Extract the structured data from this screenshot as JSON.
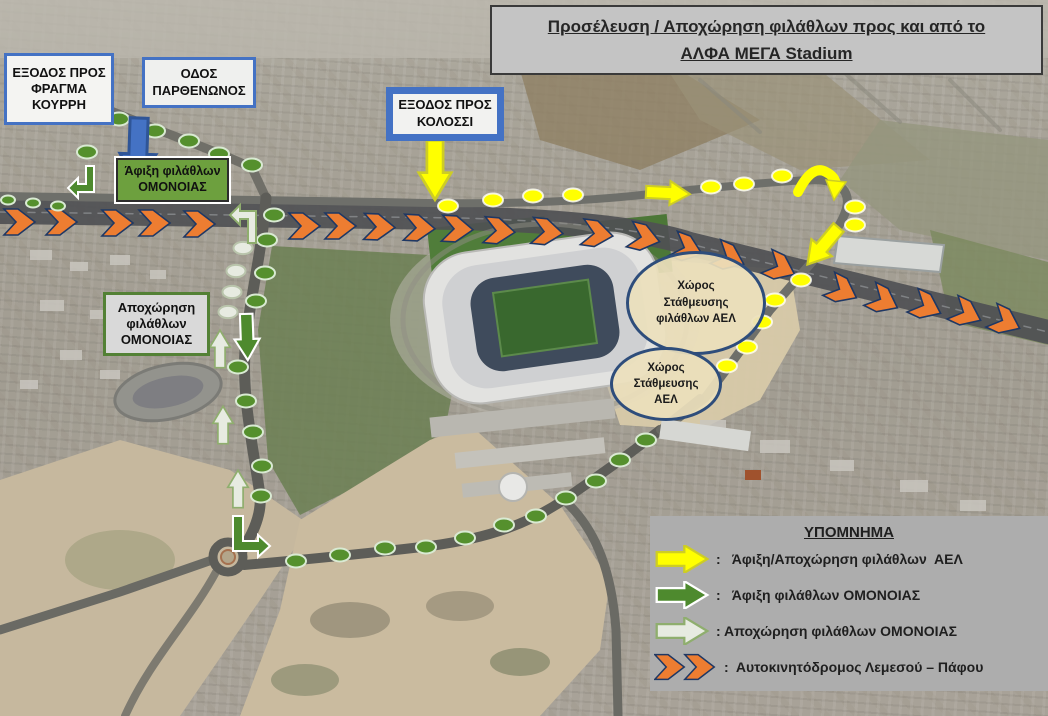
{
  "title": {
    "line1": " Προσέλευση / Αποχώρηση  φιλάθλων προς και από το",
    "line2": "ΑΛΦΑ ΜΕΓΑ Stadium"
  },
  "boxes": {
    "exit_kourri": "ΕΞΟΔΟΣ ΠΡΟΣ\nΦΡΑΓΜΑ\nΚΟΥΡΡΗ",
    "odos_parthenonos": "ΟΔΟΣ\nΠΑΡΘΕΝΩΝΟΣ",
    "exit_kolossi": "ΕΞΟΔΟΣ ΠΡΟΣ\nΚΟΛΟΣΣΙ",
    "arrival_omonoias": "Άφιξη φιλάθλων\nΟΜΟΝΟΙΑΣ",
    "departure_omonoias": "Αποχώρηση\nφιλάθλων\nΟΜΟΝΟΙΑΣ",
    "parking_ael_fans": "Χώρος\nΣτάθμευσης\nφιλάθλων  ΑΕΛ",
    "parking_ael": "Χώρος\nΣτάθμευσης\nΑΕΛ"
  },
  "legend": {
    "title": "ΥΠΟΜΝΗΜΑ",
    "items": [
      {
        "icon": "yellow-arrow-icon",
        "label": ":   Άφιξη/Αποχώρηση φιλάθλων  ΑΕΛ"
      },
      {
        "icon": "green-arrow-icon",
        "label": ":   Άφιξη φιλάθλων ΟΜΟΝΟΙΑΣ"
      },
      {
        "icon": "pale-arrow-icon",
        "label": ": Αποχώρηση φιλάθλων ΟΜΟΝΟΙΑΣ"
      },
      {
        "icon": "orange-chevrons-icon",
        "label": ":  Αυτοκινητόδρομος Λεμεσού – Πάφου"
      }
    ]
  },
  "colors": {
    "accent_blue": "#4472c4",
    "route_yellow": "#ffff00",
    "route_green": "#4e8a2e",
    "route_pale": "#e7ebe1",
    "highway_orange": "#ed7d31",
    "chevron_outline": "#1f3864",
    "title_gray": "#c4c4c4",
    "legend_gray": "#adadad",
    "arrival_box_green": "#6da03e"
  },
  "routes": {
    "highway_chevrons": [
      [
        20,
        222,
        0
      ],
      [
        62,
        222,
        0
      ],
      [
        118,
        223,
        0
      ],
      [
        155,
        223,
        0
      ],
      [
        200,
        224,
        0
      ],
      [
        305,
        226,
        0
      ],
      [
        341,
        226,
        0
      ],
      [
        380,
        227,
        2
      ],
      [
        420,
        228,
        3
      ],
      [
        458,
        229,
        3
      ],
      [
        500,
        231,
        5
      ],
      [
        548,
        232,
        6
      ],
      [
        598,
        234,
        8
      ],
      [
        645,
        238,
        14
      ],
      [
        688,
        249,
        20
      ],
      [
        730,
        258,
        24
      ],
      [
        781,
        268,
        25
      ],
      [
        843,
        291,
        27
      ],
      [
        884,
        301,
        27
      ],
      [
        927,
        307,
        25
      ],
      [
        967,
        314,
        25
      ],
      [
        1006,
        322,
        25
      ]
    ],
    "yellow_dots": [
      [
        448,
        206
      ],
      [
        493,
        200
      ],
      [
        533,
        196
      ],
      [
        573,
        195
      ],
      [
        711,
        187
      ],
      [
        744,
        184
      ],
      [
        782,
        176
      ],
      [
        855,
        207
      ],
      [
        855,
        225
      ],
      [
        801,
        280
      ],
      [
        775,
        300
      ],
      [
        762,
        322
      ],
      [
        747,
        347
      ],
      [
        727,
        366
      ]
    ],
    "green_dots": [
      [
        119,
        119
      ],
      [
        155,
        131
      ],
      [
        189,
        141
      ],
      [
        219,
        154
      ],
      [
        252,
        165
      ],
      [
        87,
        152
      ],
      [
        274,
        215
      ],
      [
        267,
        240
      ],
      [
        265,
        273
      ],
      [
        256,
        301
      ],
      [
        238,
        367
      ],
      [
        246,
        401
      ],
      [
        253,
        432
      ],
      [
        262,
        466
      ],
      [
        261,
        496
      ],
      [
        296,
        561
      ],
      [
        340,
        555
      ],
      [
        385,
        548
      ],
      [
        426,
        547
      ],
      [
        465,
        538
      ],
      [
        504,
        525
      ],
      [
        536,
        516
      ],
      [
        566,
        498
      ],
      [
        596,
        481
      ],
      [
        620,
        460
      ],
      [
        646,
        440
      ]
    ],
    "green_dots_small": [
      [
        8,
        200
      ],
      [
        33,
        203
      ],
      [
        58,
        206
      ]
    ],
    "pale_dots": [
      [
        243,
        248
      ],
      [
        236,
        271
      ],
      [
        232,
        292
      ],
      [
        228,
        312
      ]
    ],
    "block_arrows": [
      {
        "name": "blue-exit-kourri-arrow",
        "cls": "blarr",
        "x": 138,
        "y": 151,
        "rot": 92,
        "scale": 1.5
      },
      {
        "name": "yellow-exit-kolossi-arrow",
        "cls": "yarr",
        "x": 435,
        "y": 170,
        "rot": 90,
        "scale": 1.35
      },
      {
        "name": "yellow-east-arrow",
        "cls": "yarr",
        "x": 668,
        "y": 193,
        "rot": 3,
        "scale": 1.0
      },
      {
        "name": "yellow-to-parking-arrow",
        "cls": "yarr",
        "x": 823,
        "y": 246,
        "rot": 130,
        "scale": 1.1
      },
      {
        "name": "green-south-arrow",
        "cls": "garr",
        "x": 247,
        "y": 337,
        "rot": 88,
        "scale": 1.05
      },
      {
        "name": "pale-up-arrow-1",
        "cls": "parr",
        "x": 220,
        "y": 349,
        "rot": -90,
        "scale": 0.85
      },
      {
        "name": "pale-up-arrow-2",
        "cls": "parr",
        "x": 223,
        "y": 425,
        "rot": -90,
        "scale": 0.85
      },
      {
        "name": "pale-up-arrow-3",
        "cls": "parr",
        "x": 238,
        "y": 489,
        "rot": -90,
        "scale": 0.85
      }
    ]
  }
}
